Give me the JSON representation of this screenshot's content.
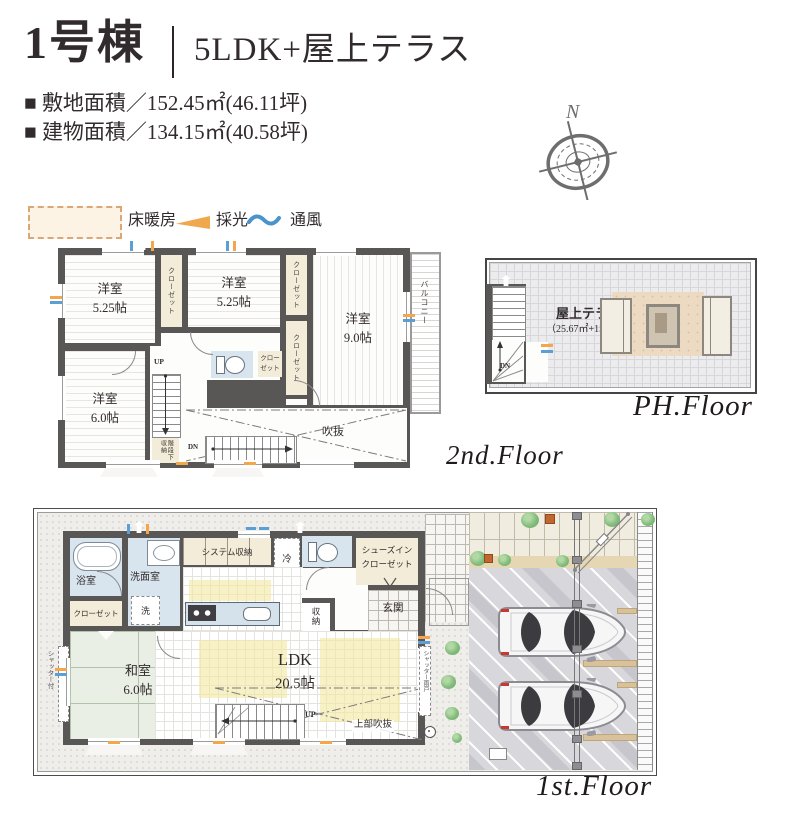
{
  "header": {
    "building": "1号棟",
    "type": "5LDK+屋上テラス",
    "areas": [
      {
        "bullet": "■",
        "text": "敷地面積／152.45㎡(46.11坪)"
      },
      {
        "bullet": "■",
        "text": "建物面積／134.15㎡(40.58坪)"
      }
    ]
  },
  "compass": {
    "north": "N"
  },
  "legend": {
    "floor_heating": "床暖房",
    "daylight": "採光",
    "ventilation": "通風"
  },
  "floor2": {
    "floor_label": "2nd.Floor",
    "rooms": [
      {
        "name": "洋室",
        "size": "5.25帖"
      },
      {
        "name": "洋室",
        "size": "5.25帖"
      },
      {
        "name": "洋室",
        "size": "9.0帖"
      },
      {
        "name": "洋室",
        "size": "6.0帖"
      }
    ],
    "closet": "クローゼット",
    "balcony": "バルコニー",
    "void_label": "吹抜",
    "understairs": "階段下収納",
    "up": "UP",
    "dn": "DN"
  },
  "floorph": {
    "floor_label": "PH.Floor",
    "terrace": "屋上テラス",
    "terrace_area": "（25.67㎡+15.5帖）",
    "dn": "DN"
  },
  "floor1": {
    "floor_label": "1st.Floor",
    "bath": "浴室",
    "washroom": "洗面室",
    "washer": "洗",
    "closet": "クローゼット",
    "jroom": {
      "name": "和室",
      "size": "6.0帖"
    },
    "ldk": {
      "name": "LDK",
      "size": "20.5帖"
    },
    "system_storage": "システム収納",
    "fridge": "冷",
    "storage": "収納",
    "entrance": "玄関",
    "shoe_closet": [
      "シューズイン",
      "クローゼット"
    ],
    "upper_void": "上部吹抜",
    "up": "UP",
    "shutter_right": "シャッター雨戸",
    "shutter_left": "シャッター付"
  }
}
